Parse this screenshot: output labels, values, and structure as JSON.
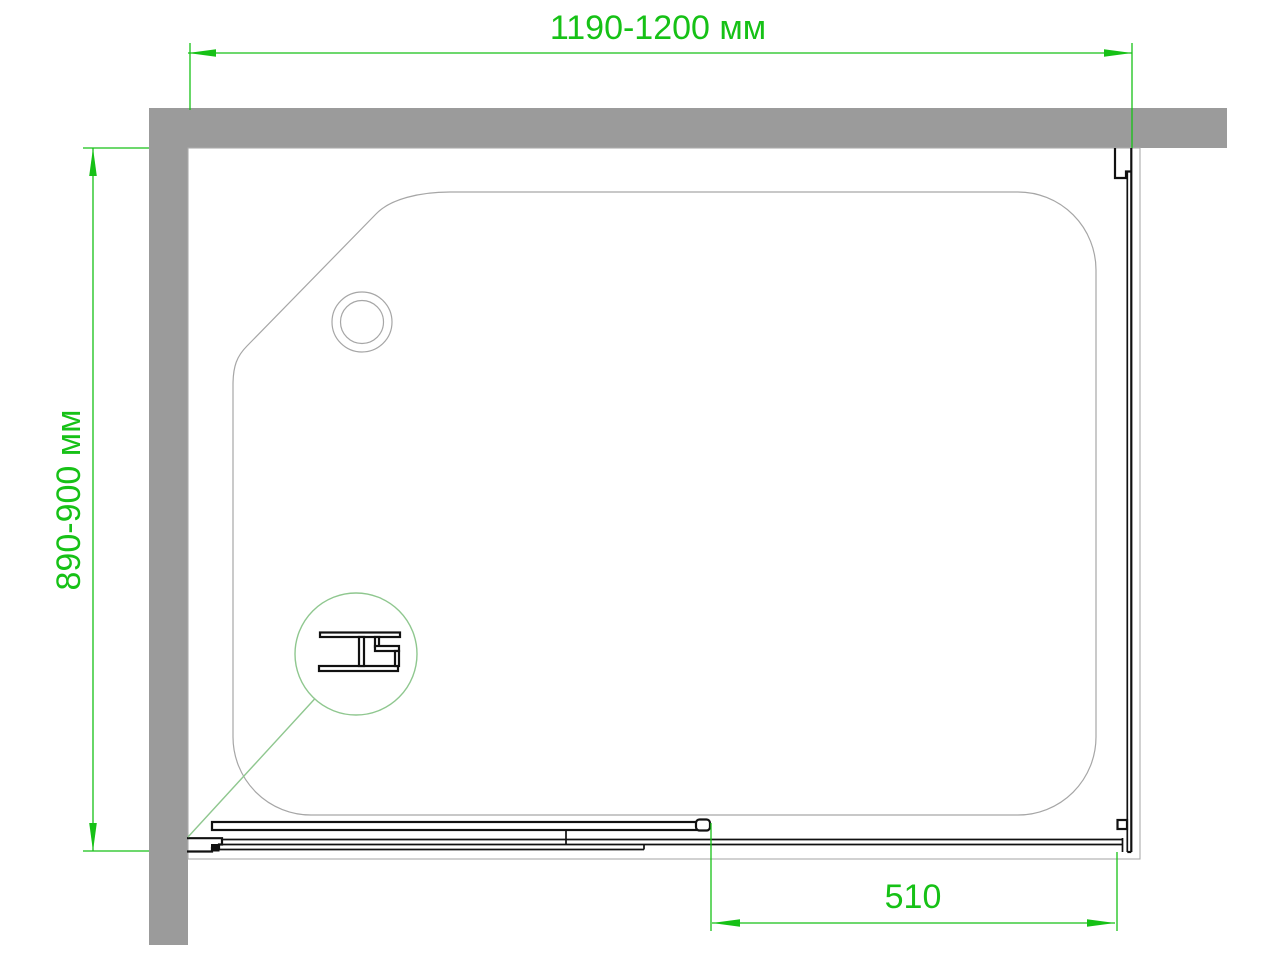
{
  "drawing": {
    "type": "shower-enclosure-plan-view",
    "labels": {
      "width_dimension": "1190-1200 мм",
      "depth_dimension": "890-900 мм",
      "door_opening_dimension": "510"
    },
    "icons": {
      "drain": "drain-circle",
      "detail": "magnifier-detail-circle",
      "profile_section": "h-connector-profile"
    }
  },
  "colors": {
    "background": "#ffffff",
    "wall_gray": "#9b9b9b",
    "outline_gray": "#ababab",
    "tray_gray": "#a6a6a6",
    "line_black": "#111111",
    "dimension_green": "#16c116",
    "detail_green": "#8fc78f"
  }
}
